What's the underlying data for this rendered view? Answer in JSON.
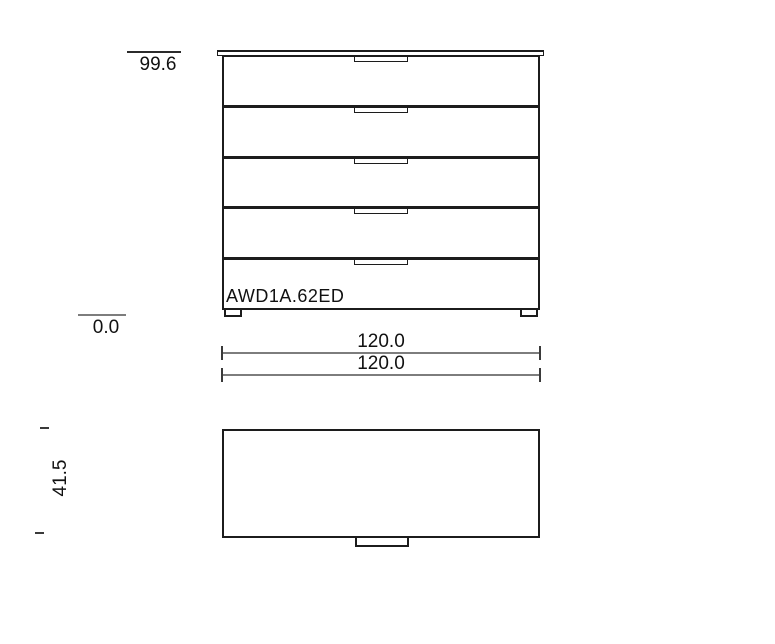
{
  "front_view": {
    "model_label": "AWD1A.62ED",
    "drawer_count": 5,
    "height_dimension": "99.6",
    "baseline_dimension": "0.0"
  },
  "width_dimensions": {
    "primary": "120.0",
    "secondary": "120.0"
  },
  "top_view": {
    "depth_dimension": "41.5"
  },
  "colors": {
    "outline": "#1c1c1c",
    "dimension_line": "#7d7d7d",
    "text": "#111111",
    "background": "#ffffff"
  }
}
